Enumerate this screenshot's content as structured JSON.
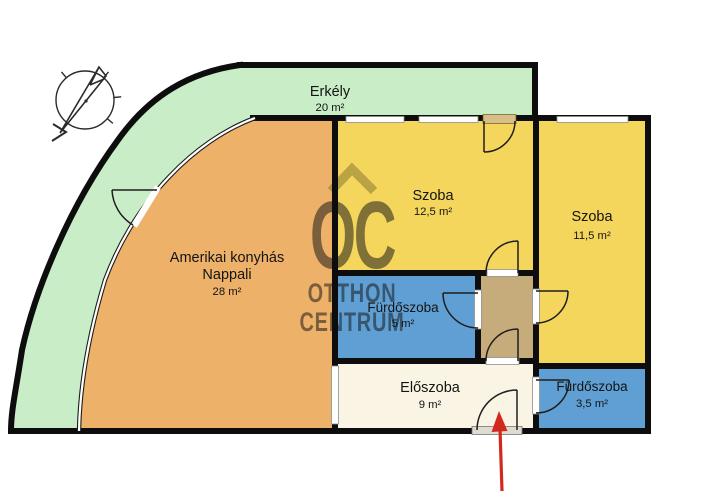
{
  "watermark": {
    "monogram": "OC",
    "line1": "OTTHON",
    "line2": "CENTRUM"
  },
  "rooms": {
    "balcony": {
      "label": "Erkély",
      "area": "20 m²",
      "color": "#c9edc7"
    },
    "living": {
      "label_line1": "Amerikai konyhás",
      "label_line2": "Nappali",
      "area": "28 m²",
      "color": "#edb169"
    },
    "room1": {
      "label": "Szoba",
      "area": "12,5 m²",
      "color": "#f4d65c"
    },
    "room2": {
      "label": "Szoba",
      "area": "11,5 m²",
      "color": "#f4d65c"
    },
    "bath1": {
      "label": "Fürdőszoba",
      "area": "5 m²",
      "color": "#5f9fd3"
    },
    "hall": {
      "label": "Előszoba",
      "area": "9 m²",
      "color": "#f9f4e4"
    },
    "bath2": {
      "label": "Fürdőszoba",
      "area": "3,5 m²",
      "color": "#5f9fd3"
    },
    "corridor": {
      "color": "#c7ac7b"
    }
  },
  "colors": {
    "wall": "#0d0d0d",
    "arrow": "#d3281e",
    "watermark_monogram": "#7e6f2e",
    "watermark_text": "#6e6c5c",
    "balcony_door_panel": "#d9be88",
    "sill": "#dfdbd0"
  },
  "icons": {
    "compass": "north-compass",
    "entrance_arrow": "entrance-direction-arrow"
  }
}
